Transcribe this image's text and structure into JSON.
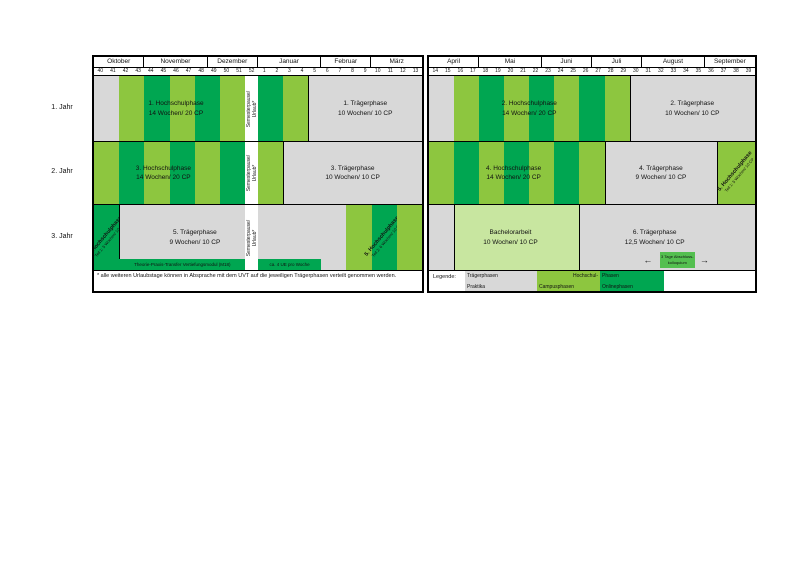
{
  "palette": {
    "gray": "#d8d8d8",
    "light": "#8dc63f",
    "dark": "#00a651",
    "pale": "#c8e6a0",
    "inset": "#54bf50",
    "white": "#ffffff"
  },
  "years": [
    "1. Jahr",
    "2. Jahr",
    "3. Jahr"
  ],
  "left_table": {
    "months": [
      {
        "label": "Oktober",
        "span": 4
      },
      {
        "label": "November",
        "span": 5
      },
      {
        "label": "Dezember",
        "span": 4
      },
      {
        "label": "Januar",
        "span": 5
      },
      {
        "label": "Februar",
        "span": 4
      },
      {
        "label": "März",
        "span": 4
      }
    ],
    "weeks": [
      "40",
      "41",
      "42",
      "43",
      "44",
      "45",
      "46",
      "47",
      "48",
      "49",
      "50",
      "51",
      "52",
      "1",
      "2",
      "3",
      "4",
      "5",
      "6",
      "7",
      "8",
      "9",
      "10",
      "11",
      "12",
      "13"
    ]
  },
  "right_table": {
    "months": [
      {
        "label": "April",
        "span": 4
      },
      {
        "label": "Mai",
        "span": 5
      },
      {
        "label": "Juni",
        "span": 4
      },
      {
        "label": "Juli",
        "span": 4
      },
      {
        "label": "August",
        "span": 5
      },
      {
        "label": "September",
        "span": 4
      }
    ],
    "weeks": [
      "14",
      "15",
      "16",
      "17",
      "18",
      "19",
      "20",
      "21",
      "22",
      "23",
      "24",
      "25",
      "26",
      "27",
      "28",
      "29",
      "30",
      "31",
      "32",
      "33",
      "34",
      "35",
      "36",
      "37",
      "38",
      "39"
    ]
  },
  "rows": [
    {
      "left": {
        "cells": [
          {
            "span": 2,
            "c": "gray"
          },
          {
            "span": 2,
            "c": "light"
          },
          {
            "span": 2,
            "c": "dark"
          },
          {
            "span": 2,
            "c": "light"
          },
          {
            "span": 2,
            "c": "dark"
          },
          {
            "span": 2,
            "c": "light"
          },
          {
            "span": 1,
            "c": "white",
            "vlines": [
              "Semesterpause/",
              "Urlaub*"
            ]
          },
          {
            "span": 2,
            "c": "dark"
          },
          {
            "span": 2,
            "c": "light"
          },
          {
            "span": 9,
            "c": "gray",
            "bl": true
          }
        ],
        "labels": [
          {
            "start": 1.5,
            "span": 10,
            "lines": [
              "1. Hochschulphase",
              "14 Wochen/ 20 CP"
            ]
          },
          {
            "start": 17,
            "span": 9,
            "lines": [
              "1. Trägerphase",
              "10 Wochen/ 10 CP"
            ]
          }
        ]
      },
      "right": {
        "cells": [
          {
            "span": 2,
            "c": "gray"
          },
          {
            "span": 2,
            "c": "light"
          },
          {
            "span": 2,
            "c": "dark"
          },
          {
            "span": 2,
            "c": "light"
          },
          {
            "span": 2,
            "c": "dark"
          },
          {
            "span": 2,
            "c": "light"
          },
          {
            "span": 2,
            "c": "dark"
          },
          {
            "span": 2,
            "c": "light"
          },
          {
            "span": 10,
            "c": "gray",
            "bl": true
          }
        ],
        "labels": [
          {
            "start": 2,
            "span": 12,
            "lines": [
              "2. Hochschulphase",
              "14 Wochen/ 20 CP"
            ]
          },
          {
            "start": 16,
            "span": 10,
            "lines": [
              "2. Trägerphase",
              "10 Wochen/ 10 CP"
            ]
          }
        ]
      }
    },
    {
      "left": {
        "cells": [
          {
            "span": 2,
            "c": "light"
          },
          {
            "span": 2,
            "c": "dark"
          },
          {
            "span": 2,
            "c": "light"
          },
          {
            "span": 2,
            "c": "dark"
          },
          {
            "span": 2,
            "c": "light"
          },
          {
            "span": 2,
            "c": "dark"
          },
          {
            "span": 1,
            "c": "white",
            "vlines": [
              "Semesterpause/",
              "Urlaub*"
            ]
          },
          {
            "span": 2,
            "c": "light"
          },
          {
            "span": 11,
            "c": "gray",
            "bl": true
          }
        ],
        "labels": [
          {
            "start": 0,
            "span": 11,
            "lines": [
              "3. Hochschulphase",
              "14 Wochen/ 20 CP"
            ]
          },
          {
            "start": 15,
            "span": 11,
            "lines": [
              "3. Trägerphase",
              "10 Wochen/ 10 CP"
            ]
          }
        ]
      },
      "right": {
        "cells": [
          {
            "span": 2,
            "c": "light"
          },
          {
            "span": 2,
            "c": "dark"
          },
          {
            "span": 2,
            "c": "light"
          },
          {
            "span": 2,
            "c": "dark"
          },
          {
            "span": 2,
            "c": "light"
          },
          {
            "span": 2,
            "c": "dark"
          },
          {
            "span": 2,
            "c": "light"
          },
          {
            "span": 9,
            "c": "gray",
            "bl": true
          },
          {
            "span": 3,
            "c": "light",
            "bl": true,
            "diag": [
              "5. Hochschulphase",
              "Teil 1: 5 Wochen/ 10 CP"
            ]
          }
        ],
        "labels": [
          {
            "start": 0,
            "span": 13.5,
            "lines": [
              "4. Hochschulphase",
              "14 Wochen/ 20 CP"
            ]
          },
          {
            "start": 14,
            "span": 9,
            "lines": [
              "4. Trägerphase",
              "9 Wochen/ 10 CP"
            ]
          }
        ]
      }
    },
    {
      "left": {
        "cells": [
          {
            "span": 2,
            "c": "dark",
            "diag": [
              "5. Hochschulphase",
              "Teil 1: 5 Wochen/ 10 CP"
            ]
          },
          {
            "span": 10,
            "c": "gray",
            "bl": true
          },
          {
            "span": 1,
            "c": "white",
            "vlines": [
              "Semesterpause/",
              "Urlaub*"
            ]
          },
          {
            "span": 7,
            "c": "gray"
          },
          {
            "span": 2,
            "c": "light"
          },
          {
            "span": 2,
            "c": "dark",
            "diag": [
              "5. Hochschulphase",
              "Teil 2: 6 Wochen/ 10 CP"
            ]
          },
          {
            "span": 2,
            "c": "light"
          }
        ],
        "labels": [
          {
            "start": 2,
            "span": 12,
            "lines": [
              "5. Trägerphase",
              "9 Wochen/ 10 CP"
            ]
          }
        ],
        "strips": [
          {
            "start": 2,
            "span": 10,
            "text": "Theorie-Praxis-Transfer Vertiefungsmodul (M18)"
          },
          {
            "start": 13,
            "span": 5,
            "text": "ca. 4 UE pro Woche"
          }
        ]
      },
      "right": {
        "cells": [
          {
            "span": 2,
            "c": "gray"
          },
          {
            "span": 10,
            "c": "pale",
            "bl": true
          },
          {
            "span": 14,
            "c": "gray",
            "bl": true
          }
        ],
        "labels": [
          {
            "start": 2,
            "span": 9,
            "lines": [
              "Bachelorarbeit",
              "10 Wochen/ 10 CP"
            ]
          },
          {
            "start": 12,
            "span": 12,
            "lines": [
              "6. Trägerphase",
              "12,5 Wochen/ 10 CP"
            ]
          }
        ],
        "inset": {
          "arrow_left": "←",
          "arrow_right": "→",
          "lines": [
            "3 Tage Abschluss-",
            "kolloquium"
          ],
          "start": 18.4,
          "span": 2.8
        }
      }
    }
  ],
  "footnote": "* alle weiteren Urlaubstage können in Absprache mit dem UVT auf die jeweiligen Trägerphasen verteilt genommen werden.",
  "legend": {
    "title": "Legende:",
    "items": [
      {
        "color": "gray",
        "top": "Trägerphasen",
        "bottom": "Praktika",
        "top_align": "left"
      },
      {
        "color": "light",
        "top": "Hochschul-",
        "bottom": "Campusphasen",
        "top_align": "right"
      },
      {
        "color": "dark",
        "top": "Phasen",
        "bottom": "Onlinephasen",
        "top_align": "left"
      }
    ]
  }
}
